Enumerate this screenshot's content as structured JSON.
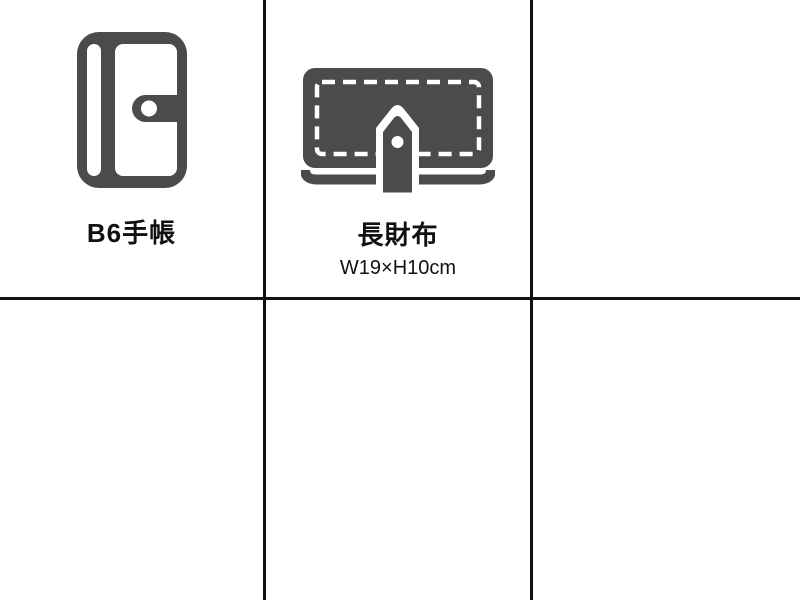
{
  "colors": {
    "background": "#ffffff",
    "grid_line": "#111111",
    "icon": "#4b4b4b",
    "text": "#111111"
  },
  "comparison_grid": {
    "columns": 3,
    "rows": 2,
    "cells": {
      "notebook": {
        "icon": "b6-notebook-icon",
        "label": "B6手帳"
      },
      "wallet": {
        "icon": "long-wallet-icon",
        "label": "長財布",
        "dimensions": "W19×H10cm"
      }
    }
  }
}
